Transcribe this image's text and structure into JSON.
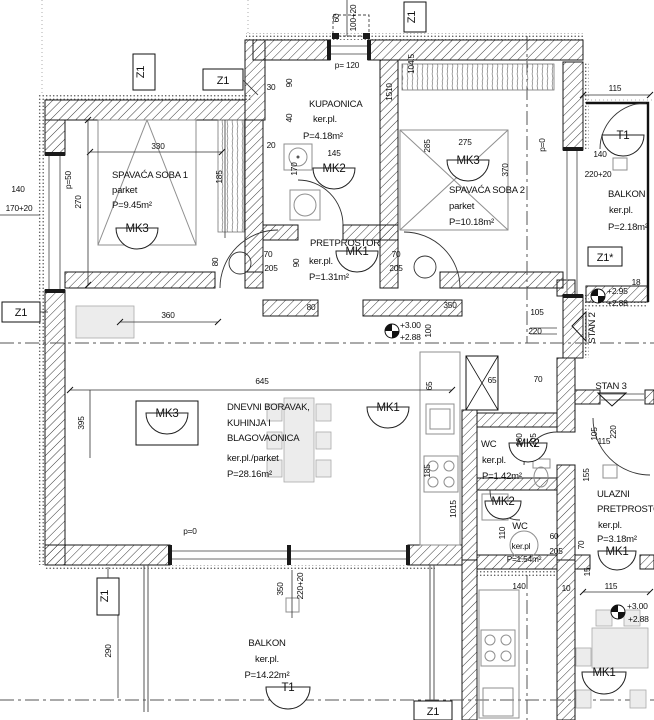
{
  "rooms": {
    "s1": {
      "name": "SPAVAĆA SOBA 1",
      "floor": "parket",
      "area": "P=9.45m²",
      "mark": "MK3"
    },
    "kup": {
      "name": "KUPAONICA",
      "floor": "ker.pl.",
      "area": "P=4.18m²",
      "mark": "MK2",
      "width": "145",
      "parapet": "p= 120"
    },
    "s2": {
      "name": "SPAVAĆA SOBA 2",
      "floor": "parket",
      "area": "P=10.18m²",
      "mark": "MK3",
      "parapet": "p=0"
    },
    "pret": {
      "name": "PRETPROSTOR",
      "floor": "ker.pl.",
      "area": "P=1.31m²",
      "mark": "MK1"
    },
    "dnevni": {
      "name_l1": "DNEVNI BORAVAK,",
      "name_l2": "KUHINJA I",
      "name_l3": "BLAGOVAONICA",
      "floor": "ker.pl./parket",
      "area": "P=28.16m²",
      "mark_a": "MK3",
      "mark_b": "MK1",
      "parapet": "p=0"
    },
    "balkon1": {
      "name": "BALKON",
      "floor": "ker.pl.",
      "area": "P=2.18m²",
      "mark": "T1"
    },
    "wc1": {
      "name": "WC",
      "floor": "ker.pl.",
      "area": "P=1.42m²",
      "mark": "MK2"
    },
    "wc2": {
      "name": "WC",
      "floor": "ker.pl",
      "area": "P=1.54m²",
      "mark": "MK2"
    },
    "ulazni": {
      "name_l1": "ULAZNI",
      "name_l2": "PRETPROSTOR",
      "floor": "ker.pl.",
      "area": "P=3.18m²",
      "mark": "MK1"
    },
    "balkon2": {
      "name": "BALKON",
      "floor": "ker.pl.",
      "area": "P=14.22m²",
      "mark": "T1"
    },
    "unit2": {
      "mark": "MK1"
    }
  },
  "marks": {
    "z1": "Z1",
    "z1_star": "Z1*",
    "stan2": "STAN 2",
    "stan3": "STAN 3"
  },
  "levels": {
    "p300": "+3.00",
    "p288": "+2.88",
    "p295": "+2.95"
  },
  "dims": {
    "d10": "10",
    "d15": "15",
    "d18": "18",
    "d20": "20",
    "d30": "30",
    "d40": "40",
    "d60": "60",
    "d65": "65",
    "d70": "70",
    "d80": "80",
    "d90": "90",
    "d100": "100",
    "d100_20": "100+20",
    "d104_5": "104.5",
    "d105": "105",
    "d110": "110",
    "d115": "115",
    "d140": "140",
    "d145": "145",
    "d155": "155",
    "d160": "160",
    "d170": "170",
    "d170_20": "170+20",
    "d185": "185",
    "d205": "205",
    "d220": "220",
    "d220_20": "220+20",
    "d270": "270",
    "d275": "275",
    "d285": "285",
    "d290": "290",
    "d330": "330",
    "d350": "350",
    "d360": "360",
    "d370": "370",
    "d395": "395",
    "d645": "645",
    "d1015": "1015",
    "d1510": "1510",
    "p0": "p=0",
    "p50": "p=50",
    "p120": "p= 120"
  }
}
